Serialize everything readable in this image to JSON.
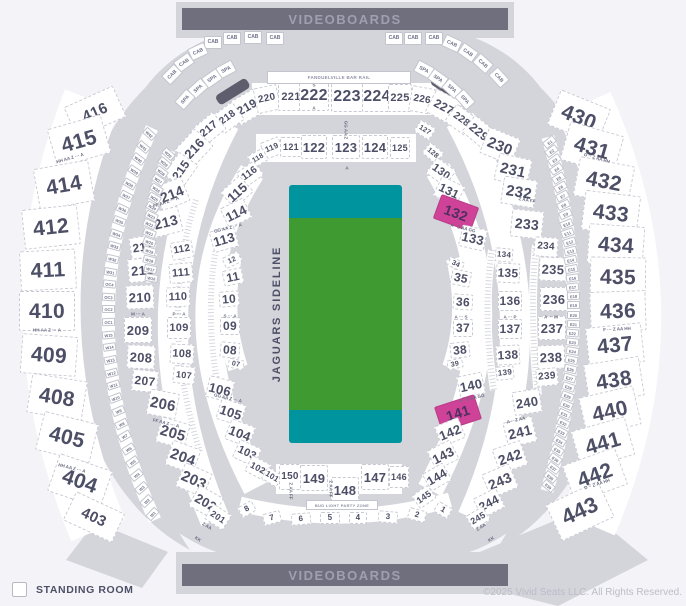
{
  "banners": {
    "top": "VIDEOBOARDS",
    "bottom": "VIDEOBOARDS"
  },
  "labels": {
    "bar_rail": "FANDUELVILLE BAR RAIL",
    "party_zone": "BUD LIGHT PARTY ZONE"
  },
  "field": {
    "sideline_label": "JAGUARS SIDELINE",
    "green": "#3f9b31",
    "teal": "#00959e"
  },
  "legend": {
    "label": "STANDING ROOM"
  },
  "copyright": "©2025 Vivid Seats LLC. All Rights Reserved.",
  "colors": {
    "selected_pink": "#ce4397",
    "base_gray": "#d4d4db",
    "text_slate": "#4d4f66",
    "videoboard": "#6f6f7e"
  },
  "selected_sections": [
    "132",
    "141"
  ],
  "sections": [
    [
      "416",
      95,
      112,
      54,
      34,
      -24,
      15
    ],
    [
      "415",
      79,
      141,
      56,
      40,
      -16,
      21
    ],
    [
      "414",
      64,
      185,
      56,
      42,
      -10,
      21
    ],
    [
      "412",
      51,
      227,
      56,
      40,
      -6,
      21
    ],
    [
      "411",
      48,
      270,
      56,
      40,
      -3,
      21
    ],
    [
      "410",
      47,
      311,
      56,
      40,
      0,
      21
    ],
    [
      "409",
      49,
      355,
      56,
      40,
      4,
      21
    ],
    [
      "408",
      57,
      397,
      56,
      40,
      9,
      21
    ],
    [
      "405",
      67,
      437,
      56,
      40,
      14,
      21
    ],
    [
      "404",
      80,
      481,
      56,
      40,
      19,
      21
    ],
    [
      "403",
      94,
      517,
      54,
      32,
      25,
      15
    ],
    [
      "430",
      579,
      117,
      54,
      38,
      22,
      21
    ],
    [
      "431",
      592,
      148,
      56,
      40,
      16,
      21
    ],
    [
      "432",
      604,
      181,
      56,
      40,
      11,
      21
    ],
    [
      "433",
      611,
      213,
      56,
      40,
      7,
      21
    ],
    [
      "434",
      616,
      245,
      56,
      40,
      4,
      21
    ],
    [
      "435",
      618,
      277,
      56,
      40,
      1,
      21
    ],
    [
      "436",
      618,
      311,
      56,
      40,
      -2,
      21
    ],
    [
      "437",
      615,
      345,
      56,
      40,
      -6,
      21
    ],
    [
      "438",
      614,
      380,
      56,
      40,
      -9,
      21
    ],
    [
      "440",
      610,
      411,
      56,
      40,
      -13,
      21
    ],
    [
      "441",
      603,
      443,
      56,
      40,
      -16,
      21
    ],
    [
      "442",
      595,
      475,
      56,
      40,
      -20,
      21
    ],
    [
      "443",
      580,
      511,
      58,
      40,
      -25,
      22
    ],
    [
      "219",
      247,
      107,
      30,
      26,
      -30,
      12
    ],
    [
      "220",
      267,
      99,
      24,
      26,
      -12,
      10
    ],
    [
      "221",
      291,
      97,
      26,
      28,
      0,
      11
    ],
    [
      "222",
      314,
      96,
      30,
      30,
      0,
      16
    ],
    [
      "223",
      347,
      97,
      32,
      30,
      0,
      16
    ],
    [
      "224",
      377,
      97,
      30,
      30,
      0,
      16
    ],
    [
      "225",
      400,
      98,
      24,
      28,
      0,
      11
    ],
    [
      "226",
      422,
      100,
      24,
      26,
      10,
      10
    ],
    [
      "227",
      444,
      107,
      30,
      26,
      28,
      12
    ],
    [
      "218",
      228,
      118,
      26,
      22,
      -36,
      10
    ],
    [
      "217",
      209,
      129,
      28,
      22,
      -40,
      11
    ],
    [
      "216",
      194,
      148,
      30,
      26,
      -47,
      13
    ],
    [
      "215",
      181,
      170,
      28,
      24,
      -55,
      12
    ],
    [
      "214",
      172,
      194,
      30,
      26,
      -22,
      14
    ],
    [
      "213",
      166,
      222,
      30,
      26,
      -14,
      14
    ],
    [
      "212",
      143,
      247,
      26,
      22,
      -9,
      12
    ],
    [
      "211",
      142,
      270,
      28,
      24,
      -5,
      13
    ],
    [
      "210",
      140,
      297,
      28,
      24,
      -2,
      13
    ],
    [
      "209",
      138,
      330,
      28,
      26,
      0,
      13
    ],
    [
      "208",
      141,
      357,
      28,
      24,
      3,
      13
    ],
    [
      "207",
      145,
      381,
      26,
      22,
      6,
      12
    ],
    [
      "206",
      163,
      404,
      30,
      26,
      11,
      15
    ],
    [
      "205",
      173,
      433,
      30,
      26,
      16,
      15
    ],
    [
      "204",
      183,
      457,
      30,
      26,
      20,
      15
    ],
    [
      "203",
      194,
      480,
      30,
      26,
      24,
      15
    ],
    [
      "202",
      206,
      502,
      28,
      24,
      29,
      13
    ],
    [
      "201",
      218,
      517,
      22,
      18,
      33,
      9
    ],
    [
      "228",
      461,
      120,
      26,
      22,
      36,
      10
    ],
    [
      "229",
      479,
      132,
      28,
      22,
      40,
      12
    ],
    [
      "230",
      500,
      146,
      34,
      28,
      22,
      15
    ],
    [
      "231",
      513,
      170,
      34,
      28,
      13,
      15
    ],
    [
      "232",
      519,
      192,
      34,
      28,
      9,
      15
    ],
    [
      "233",
      527,
      224,
      32,
      28,
      6,
      14
    ],
    [
      "234",
      546,
      247,
      24,
      20,
      4,
      10
    ],
    [
      "235",
      553,
      269,
      28,
      24,
      2,
      13
    ],
    [
      "236",
      554,
      299,
      28,
      24,
      0,
      13
    ],
    [
      "237",
      552,
      328,
      28,
      24,
      0,
      13
    ],
    [
      "238",
      551,
      357,
      28,
      24,
      -2,
      13
    ],
    [
      "239",
      547,
      377,
      22,
      18,
      -5,
      10
    ],
    [
      "240",
      527,
      402,
      28,
      24,
      -9,
      13
    ],
    [
      "241",
      520,
      432,
      30,
      26,
      -14,
      14
    ],
    [
      "242",
      510,
      457,
      30,
      26,
      -19,
      14
    ],
    [
      "243",
      500,
      481,
      30,
      26,
      -23,
      14
    ],
    [
      "244",
      489,
      503,
      26,
      22,
      -27,
      12
    ],
    [
      "245",
      478,
      518,
      20,
      16,
      -31,
      9
    ],
    [
      "119",
      272,
      148,
      20,
      18,
      -22,
      8
    ],
    [
      "121",
      291,
      147,
      22,
      20,
      0,
      9
    ],
    [
      "122",
      314,
      147,
      26,
      24,
      0,
      13
    ],
    [
      "123",
      346,
      147,
      28,
      24,
      0,
      13
    ],
    [
      "124",
      375,
      147,
      26,
      24,
      0,
      13
    ],
    [
      "125",
      400,
      148,
      20,
      22,
      0,
      9
    ],
    [
      "127",
      425,
      130,
      18,
      14,
      32,
      7
    ],
    [
      "128",
      433,
      153,
      18,
      14,
      40,
      7
    ],
    [
      "118",
      258,
      158,
      18,
      14,
      -30,
      7
    ],
    [
      "116",
      250,
      174,
      22,
      18,
      -36,
      10
    ],
    [
      "115",
      237,
      192,
      26,
      22,
      -42,
      13
    ],
    [
      "114",
      236,
      213,
      26,
      22,
      -26,
      13
    ],
    [
      "113",
      224,
      239,
      26,
      22,
      -16,
      13
    ],
    [
      "112",
      182,
      250,
      22,
      18,
      -10,
      10
    ],
    [
      "111",
      181,
      273,
      24,
      20,
      -5,
      11
    ],
    [
      "110",
      178,
      297,
      24,
      20,
      -2,
      11
    ],
    [
      "109",
      179,
      328,
      24,
      22,
      0,
      11
    ],
    [
      "108",
      182,
      354,
      24,
      20,
      3,
      11
    ],
    [
      "107",
      184,
      375,
      22,
      18,
      6,
      9
    ],
    [
      "106",
      220,
      389,
      26,
      22,
      14,
      13
    ],
    [
      "105",
      231,
      412,
      26,
      22,
      18,
      13
    ],
    [
      "104",
      240,
      433,
      26,
      22,
      21,
      13
    ],
    [
      "103",
      247,
      453,
      24,
      20,
      25,
      11
    ],
    [
      "102",
      258,
      468,
      22,
      18,
      28,
      9
    ],
    [
      "101",
      272,
      477,
      18,
      14,
      31,
      8
    ],
    [
      "130",
      441,
      172,
      24,
      20,
      36,
      11
    ],
    [
      "131",
      449,
      191,
      26,
      22,
      26,
      12
    ],
    [
      "132",
      456,
      213,
      40,
      26,
      20,
      14,
      "p"
    ],
    [
      "133",
      473,
      238,
      26,
      22,
      13,
      13
    ],
    [
      "134",
      504,
      255,
      18,
      14,
      5,
      8
    ],
    [
      "135",
      508,
      273,
      24,
      20,
      3,
      12
    ],
    [
      "136",
      510,
      301,
      24,
      20,
      0,
      12
    ],
    [
      "137",
      510,
      329,
      24,
      20,
      0,
      12
    ],
    [
      "138",
      508,
      355,
      24,
      20,
      -3,
      12
    ],
    [
      "139",
      505,
      373,
      18,
      14,
      -6,
      8
    ],
    [
      "140",
      471,
      385,
      26,
      22,
      -12,
      13
    ],
    [
      "141",
      458,
      413,
      42,
      26,
      -18,
      14,
      "p"
    ],
    [
      "142",
      450,
      432,
      26,
      22,
      -22,
      13
    ],
    [
      "143",
      443,
      455,
      26,
      22,
      -27,
      13
    ],
    [
      "144",
      437,
      477,
      24,
      20,
      -30,
      12
    ],
    [
      "145",
      424,
      497,
      20,
      16,
      -35,
      9
    ],
    [
      "146",
      399,
      477,
      20,
      22,
      0,
      9
    ],
    [
      "147",
      375,
      477,
      28,
      26,
      0,
      13
    ],
    [
      "148",
      345,
      490,
      28,
      26,
      0,
      13
    ],
    [
      "149",
      314,
      478,
      28,
      26,
      0,
      13
    ],
    [
      "150",
      290,
      477,
      22,
      26,
      0,
      10
    ],
    [
      "12",
      232,
      260,
      18,
      12,
      -25,
      7
    ],
    [
      "11",
      233,
      277,
      20,
      16,
      -12,
      12
    ],
    [
      "10",
      229,
      299,
      20,
      16,
      -5,
      12
    ],
    [
      "09",
      230,
      326,
      20,
      18,
      0,
      12
    ],
    [
      "08",
      230,
      350,
      20,
      16,
      5,
      12
    ],
    [
      "07",
      236,
      364,
      16,
      10,
      12,
      7
    ],
    [
      "34",
      456,
      264,
      16,
      10,
      25,
      7
    ],
    [
      "35",
      461,
      278,
      20,
      16,
      12,
      12
    ],
    [
      "36",
      463,
      302,
      20,
      16,
      4,
      12
    ],
    [
      "37",
      463,
      328,
      20,
      18,
      0,
      12
    ],
    [
      "38",
      460,
      350,
      20,
      16,
      -6,
      12
    ],
    [
      "39",
      455,
      364,
      16,
      10,
      -12,
      7
    ],
    [
      "8",
      247,
      509,
      16,
      12,
      -30,
      8
    ],
    [
      "7",
      272,
      518,
      18,
      12,
      -15,
      8
    ],
    [
      "6",
      301,
      519,
      20,
      12,
      -5,
      8
    ],
    [
      "5",
      330,
      518,
      20,
      12,
      0,
      8
    ],
    [
      "4",
      358,
      518,
      18,
      12,
      0,
      8
    ],
    [
      "3",
      388,
      517,
      20,
      12,
      5,
      8
    ],
    [
      "2",
      417,
      515,
      18,
      12,
      15,
      8
    ],
    [
      "1",
      443,
      510,
      16,
      12,
      30,
      8
    ]
  ],
  "tiny_boxes": [
    [
      "CAB",
      213,
      42,
      0
    ],
    [
      "CAB",
      232,
      38,
      0
    ],
    [
      "CAB",
      253,
      37,
      0
    ],
    [
      "CAB",
      275,
      38,
      0
    ],
    [
      "CAB",
      394,
      38,
      0
    ],
    [
      "CAB",
      413,
      38,
      0
    ],
    [
      "CAB",
      434,
      38,
      0
    ],
    [
      "CAB",
      198,
      51,
      -25
    ],
    [
      "CAB",
      184,
      62,
      -35
    ],
    [
      "CAB",
      172,
      74,
      -45
    ],
    [
      "CAB",
      452,
      43,
      25
    ],
    [
      "CAB",
      468,
      52,
      35
    ],
    [
      "CAB",
      483,
      63,
      42
    ],
    [
      "CAB",
      499,
      77,
      48
    ],
    [
      "SPA",
      226,
      69,
      -28
    ],
    [
      "SPA",
      212,
      78,
      -35
    ],
    [
      "SPA",
      198,
      88,
      -42
    ],
    [
      "SPA",
      185,
      99,
      -48
    ],
    [
      "SPA",
      424,
      69,
      28
    ],
    [
      "SPA",
      438,
      78,
      35
    ],
    [
      "SPA",
      452,
      88,
      42
    ],
    [
      "SPA",
      465,
      99,
      48
    ]
  ],
  "strips": [
    {
      "labels": [
        "W42",
        "W41",
        "W40",
        "W39",
        "W38",
        "W37",
        "W36",
        "W35",
        "W34",
        "W33",
        "W32",
        "W31",
        "OC4",
        "OC3",
        "OC2",
        "OC1",
        "W15",
        "W14",
        "W13",
        "W12",
        "W11",
        "W10",
        "W9",
        "W8",
        "W7",
        "W6",
        "W5",
        "W4",
        "W3",
        "W2",
        "W1"
      ],
      "p0": [
        152,
        128
      ],
      "c": [
        63,
        320
      ],
      "p1": [
        155,
        520
      ]
    },
    {
      "labels": [
        "W30",
        "W29",
        "W28",
        "W27",
        "W26",
        "W25",
        "W24",
        "W23",
        "W22",
        "W21",
        "W20",
        "W19",
        "W18",
        "W17",
        "W16"
      ],
      "p0": [
        170,
        150
      ],
      "c": [
        141,
        215
      ],
      "p1": [
        152,
        282
      ]
    },
    {
      "labels": [
        "E1",
        "E2",
        "E3",
        "E4",
        "E5",
        "E6",
        "E7",
        "E8",
        "E9",
        "E10",
        "E11",
        "E12",
        "E13",
        "E14",
        "E15",
        "E16",
        "E17",
        "E18",
        "E19",
        "E20",
        "E21",
        "E22",
        "E23",
        "E24",
        "E25",
        "E26",
        "E27",
        "E28",
        "E29",
        "E30",
        "E31",
        "E32",
        "E33",
        "E34",
        "E35",
        "E36",
        "E37",
        "E38",
        "E39"
      ],
      "p0": [
        548,
        137
      ],
      "c": [
        599,
        315
      ],
      "p1": [
        547,
        491
      ]
    }
  ],
  "row_labels": [
    [
      "HH AA Z ··· A",
      70,
      158,
      -16
    ],
    [
      "HH AA Z ··· A",
      47,
      330,
      0
    ],
    [
      "HH AA Z ··· A",
      72,
      468,
      14
    ],
    [
      "D ·· Z AA HH",
      597,
      158,
      16
    ],
    [
      "F ··· Z AA HH",
      617,
      329,
      -3
    ],
    [
      "D ·· Z AA HH",
      597,
      484,
      -18
    ],
    [
      "FF AA Z ··· A",
      166,
      202,
      -18
    ],
    [
      "M ··· A",
      138,
      314,
      0
    ],
    [
      "FF AA Z ··· A",
      166,
      423,
      14
    ],
    [
      "GG AA Z ··· A",
      228,
      228,
      -14
    ],
    [
      "GG AA Z ··· A",
      228,
      398,
      13
    ],
    [
      "P ··· A",
      179,
      314,
      0
    ],
    [
      "S ··· A",
      230,
      316,
      0
    ],
    [
      "A ··· S",
      461,
      317,
      0
    ],
    [
      "A ··· P",
      510,
      317,
      0
    ],
    [
      "A ··· M",
      551,
      317,
      0
    ],
    [
      "Z AA FF",
      527,
      200,
      10
    ],
    [
      "A · Z AA GG",
      463,
      228,
      14
    ],
    [
      "A · Z AA GG",
      472,
      398,
      -12
    ],
    [
      "A ·· Z AA",
      516,
      420,
      -13
    ],
    [
      "Z AA",
      481,
      527,
      -33
    ],
    [
      "KK",
      491,
      539,
      -33
    ],
    [
      "Z AA",
      207,
      526,
      32
    ],
    [
      "KK",
      198,
      539,
      32
    ],
    [
      "S",
      314,
      85,
      0
    ],
    [
      "A",
      314,
      108,
      0
    ],
    [
      "A",
      347,
      168,
      0
    ],
    [
      "GG AA Z",
      346,
      130,
      90
    ],
    [
      "Z AA FF",
      331,
      489,
      90
    ],
    [
      "Z AA FF",
      291,
      491,
      90
    ]
  ]
}
